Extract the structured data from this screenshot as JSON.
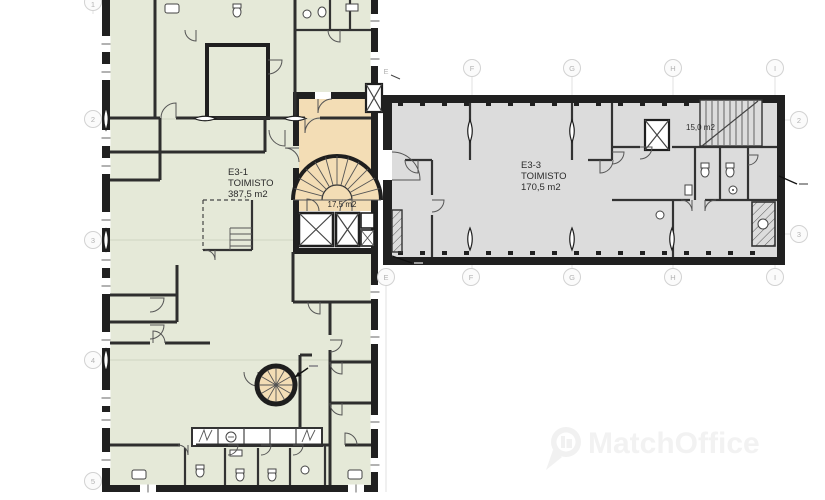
{
  "plan": {
    "units": {
      "unit1": {
        "id": "E3-1",
        "type": "TOIMISTO",
        "area": "387,5 m2"
      },
      "unit2": {
        "id": "E3-3",
        "type": "TOIMISTO",
        "area": "170,5 m2"
      }
    },
    "rooms": {
      "stairwell_area": "17,5 m2",
      "top_right_room_area": "15,0 m2"
    },
    "colors": {
      "wing_left_fill": "#e5e9d8",
      "wing_right_fill": "#dcdcdc",
      "stairwell_fill": "#f3ddb5",
      "wall": "#202020",
      "grid_bubble": "#d2d2d2"
    }
  },
  "grid": {
    "left": [
      "1",
      "2",
      "3",
      "4",
      "5"
    ],
    "top": [
      "F",
      "G",
      "H",
      "I"
    ],
    "top_e": "E",
    "bottom": [
      "E",
      "F",
      "G",
      "H",
      "I"
    ],
    "right": [
      "2",
      "3"
    ]
  },
  "watermark": {
    "text": "MatchOffice",
    "icon": "location-pin-building-icon"
  }
}
